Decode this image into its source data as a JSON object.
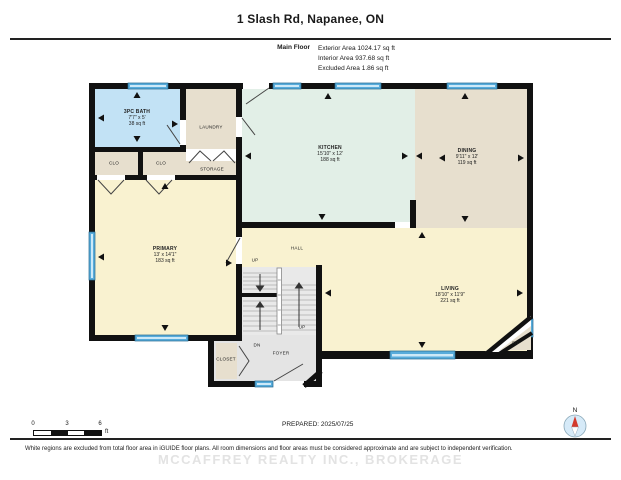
{
  "header": {
    "title": "1 Slash Rd, Napanee, ON",
    "floor_label": "Main Floor",
    "area_lines": [
      "Exterior Area 1024.17 sq ft",
      "Interior Area 937.68 sq ft",
      "Excluded Area 1.86 sq ft"
    ]
  },
  "rooms": {
    "bath": {
      "name": "3PC BATH",
      "dims": "7'7\" x 5'",
      "area": "38 sq ft"
    },
    "laundry": {
      "name": "LAUNDRY"
    },
    "clo_left": {
      "name": "CLO"
    },
    "clo_right": {
      "name": "CLO"
    },
    "storage": {
      "name": "STORAGE"
    },
    "kitchen": {
      "name": "KITCHEN",
      "dims": "15'10\" x 12'",
      "area": "188 sq ft"
    },
    "dining": {
      "name": "DINING",
      "dims": "9'11\" x 12'",
      "area": "119 sq ft"
    },
    "primary": {
      "name": "PRIMARY",
      "dims": "13' x 14'1\"",
      "area": "183 sq ft"
    },
    "hall": {
      "name": "HALL"
    },
    "living": {
      "name": "LIVING",
      "dims": "18'10\" x 11'9\"",
      "area": "221 sq ft"
    },
    "closet": {
      "name": "CLOSET"
    },
    "foyer": {
      "name": "FOYER"
    },
    "fireplace": {
      "name": "F/P"
    }
  },
  "stairs": {
    "up_top": "UP",
    "down": "DN",
    "up_right": "UP"
  },
  "footer": {
    "scale": {
      "tick0": "0",
      "tick3": "3",
      "tick6": "6",
      "unit": "ft"
    },
    "prepared": "PREPARED: 2025/07/25",
    "compass_north": "N",
    "disclaimer": "White regions are excluded from total floor area in iGUIDE floor plans. All room dimensions and floor areas must be considered approximate and are subject to independent verification.",
    "watermark": "MCCAFFREY REALTY INC., BROKERAGE"
  },
  "colors": {
    "wall": "#111111",
    "window": "#58acdb",
    "bath": "#c2e2f5",
    "beige": "#e7dfce",
    "kitchen": "#e2efe7",
    "yellow": "#f9f2d0",
    "gray": "#e7e7e7"
  }
}
